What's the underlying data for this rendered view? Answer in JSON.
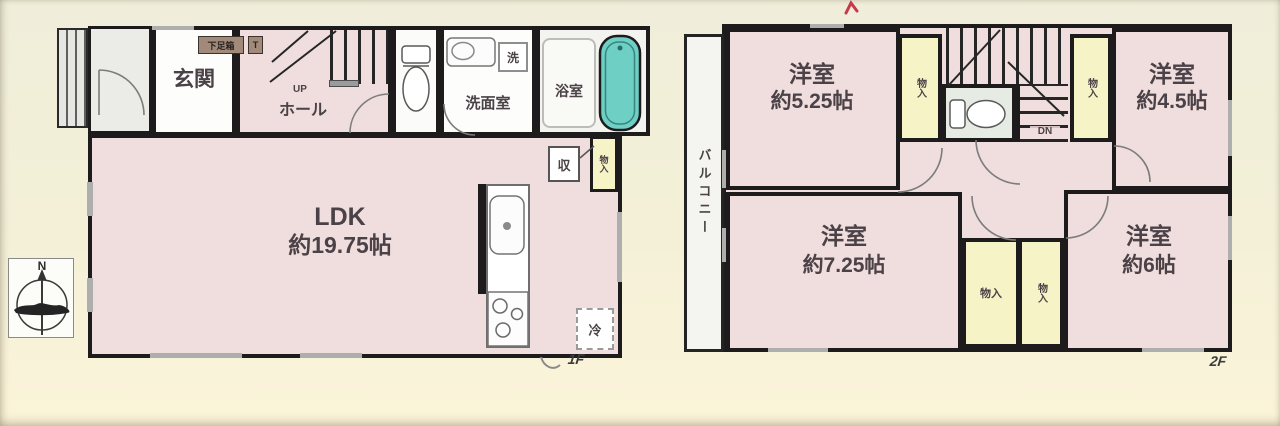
{
  "floor1": {
    "floor_label": "1F",
    "entrance_label": "玄関",
    "shoe_cabinet_label": "下足箱",
    "shoe_cabinet_tag": "T",
    "stairs_up_label": "UP",
    "hall_label": "ホール",
    "washroom_label": "洗面室",
    "laundry_label": "洗",
    "bathroom_label": "浴室",
    "ldk_name": "LDK",
    "ldk_size": "約19.75帖",
    "storage_label": "収",
    "closet_label": "物入",
    "fridge_label": "冷"
  },
  "floor2": {
    "floor_label": "2F",
    "balcony_label": "バルコニー",
    "stairs_down_label": "DN",
    "room_nw": {
      "name": "洋室",
      "size": "約5.25帖"
    },
    "room_ne": {
      "name": "洋室",
      "size": "約4.5帖"
    },
    "room_sw": {
      "name": "洋室",
      "size": "約7.25帖"
    },
    "room_se": {
      "name": "洋室",
      "size": "約6帖"
    },
    "closet_nw": "物入",
    "closet_ne": "物入",
    "closet_center_left": "物入",
    "closet_center_right": "物入"
  },
  "compass": {
    "north_label": "N"
  },
  "colors": {
    "background_cream": "#f3f0da",
    "room_pink": "#f0dddd",
    "closet_yellow": "#f6f3c6",
    "bathtub_teal": "#6ecfc5",
    "wall_black": "#1d1b1b",
    "label_ink": "#4b4247",
    "red_mark": "#c43a4b"
  }
}
